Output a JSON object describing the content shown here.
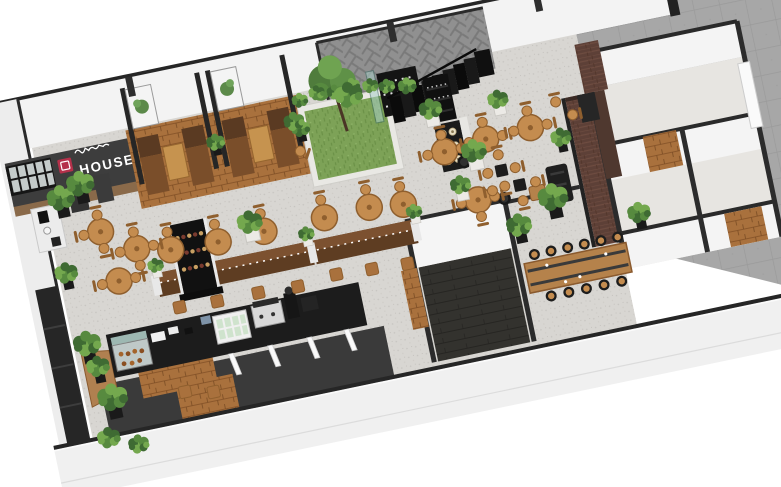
{
  "sign": {
    "brand": "HOUSE",
    "badge_color": "#b5304a",
    "panel_color": "#3d3d3d",
    "text_color": "#ffffff"
  },
  "scene": {
    "palette": {
      "wall_white": "#f3f3f3",
      "wall_cap": "#262626",
      "floor": "#d8d6d2",
      "paving": "#a7a7a7",
      "walkway": "#3a3a3a",
      "wood_top": "#c48c4f",
      "wood_edge": "#8f5f2e",
      "wood_mid": "#a9713d",
      "bench_dark": "#5e3d22",
      "bench_mid": "#7c5130",
      "plant_dark": "#3f6b33",
      "plant_mid": "#578a3f",
      "plant_light": "#74a84e",
      "black_unit": "#141414",
      "glass": "#aacfc9",
      "brick": "#5d4037",
      "grass": "#7da257"
    },
    "rotation_deg": -11.8,
    "origin": [
      32,
      148
    ],
    "tables": [
      [
        50,
        96
      ],
      [
        82,
        120
      ],
      [
        58,
        148
      ],
      [
        115,
        128
      ],
      [
        163,
        130
      ],
      [
        210,
        129
      ],
      [
        272,
        128
      ],
      [
        318,
        127
      ],
      [
        352,
        131
      ],
      [
        403,
        88
      ],
      [
        446,
        84
      ],
      [
        492,
        82
      ],
      [
        426,
        142
      ]
    ],
    "pedestal_tables": [
      [
        420,
        102
      ],
      [
        452,
        146
      ]
    ],
    "square_tables": [
      [
        455,
        118
      ],
      [
        470,
        136
      ]
    ],
    "chairs": [
      [
        33,
        96,
        270
      ],
      [
        50,
        79,
        0
      ],
      [
        50,
        113,
        180
      ],
      [
        65,
        120,
        270
      ],
      [
        99,
        120,
        90
      ],
      [
        82,
        103,
        0
      ],
      [
        82,
        137,
        180
      ],
      [
        41,
        148,
        270
      ],
      [
        75,
        148,
        90
      ],
      [
        115,
        110,
        0
      ],
      [
        163,
        112,
        0
      ],
      [
        210,
        111,
        0
      ],
      [
        272,
        110,
        0
      ],
      [
        318,
        109,
        0
      ],
      [
        352,
        113,
        0
      ],
      [
        386,
        88,
        270
      ],
      [
        403,
        71,
        0
      ],
      [
        420,
        88,
        90
      ],
      [
        429,
        84,
        270
      ],
      [
        446,
        67,
        0
      ],
      [
        463,
        84,
        90
      ],
      [
        475,
        82,
        270
      ],
      [
        492,
        65,
        0
      ],
      [
        509,
        82,
        90
      ],
      [
        409,
        142,
        270
      ],
      [
        426,
        159,
        180
      ],
      [
        443,
        142,
        90
      ],
      [
        441,
        118,
        270
      ],
      [
        455,
        102,
        0
      ],
      [
        469,
        118,
        90
      ],
      [
        455,
        134,
        180
      ],
      [
        486,
        136,
        90
      ],
      [
        442,
        136,
        270
      ],
      [
        470,
        152,
        180
      ],
      [
        522,
        62,
        0
      ],
      [
        536,
        78,
        90
      ],
      [
        262,
        58,
        120
      ]
    ],
    "stool_squares": [
      [
        112,
        186
      ],
      [
        150,
        188
      ],
      [
        192,
        188
      ],
      [
        232,
        190
      ],
      [
        272,
        186
      ],
      [
        308,
        188
      ],
      [
        344,
        190
      ],
      [
        100,
        270
      ],
      [
        128,
        276
      ]
    ],
    "communal_stools": [
      [
        470,
        207
      ],
      [
        487,
        207
      ],
      [
        504,
        207
      ],
      [
        521,
        207
      ],
      [
        538,
        207
      ],
      [
        555,
        207
      ],
      [
        478,
        251
      ],
      [
        496,
        251
      ],
      [
        514,
        251
      ],
      [
        532,
        251
      ],
      [
        550,
        251
      ]
    ],
    "wall_posts": [
      109,
      376,
      525,
      602
    ],
    "steps": {
      "x0": 360,
      "y0": 24,
      "count": 8,
      "dx": 11.5,
      "dy": -3.2,
      "w": 11.6,
      "h": 26
    },
    "plants": [
      [
        18,
        58,
        1.2,
        "b"
      ],
      [
        8,
        132,
        1.0,
        "b"
      ],
      [
        14,
        206,
        1.2,
        "b"
      ],
      [
        28,
        264,
        1.3,
        "b"
      ],
      [
        16,
        302,
        1.0,
        "n"
      ],
      [
        44,
        314,
        0.9,
        "n"
      ],
      [
        40,
        48,
        1.2,
        "b"
      ],
      [
        20,
        230,
        1.0,
        "b"
      ],
      [
        181,
        34,
        0.8,
        "b"
      ],
      [
        267,
        38,
        0.8,
        "b"
      ],
      [
        97,
        142,
        0.7,
        "w"
      ],
      [
        251,
        142,
        0.7,
        "w"
      ],
      [
        361,
        142,
        0.7,
        "w"
      ],
      [
        198,
        120,
        1.1,
        "w"
      ],
      [
        262,
        30,
        0.9,
        "n"
      ],
      [
        272,
        10,
        0.7,
        "n"
      ],
      [
        290,
        6,
        0.7,
        "n"
      ],
      [
        308,
        9,
        0.7,
        "n"
      ],
      [
        326,
        6,
        0.7,
        "n"
      ],
      [
        344,
        10,
        0.7,
        "n"
      ],
      [
        360,
        14,
        0.7,
        "n"
      ],
      [
        380,
        18,
        0.8,
        "n"
      ],
      [
        321,
        16,
        1.2,
        "n"
      ],
      [
        398,
        46,
        1.0,
        "w"
      ],
      [
        432,
        96,
        1.1,
        "w"
      ],
      [
        466,
        50,
        0.9,
        "w"
      ],
      [
        412,
        126,
        0.9,
        "w"
      ],
      [
        500,
        158,
        1.3,
        "b"
      ],
      [
        520,
        100,
        0.9,
        "b"
      ],
      [
        461,
        178,
        1.1,
        "b"
      ],
      [
        581,
        190,
        1.0,
        "b"
      ]
    ],
    "jar_shelf_rows": [
      70,
      84,
      98
    ],
    "wine_bottle_rows": [
      118,
      134,
      150
    ]
  }
}
